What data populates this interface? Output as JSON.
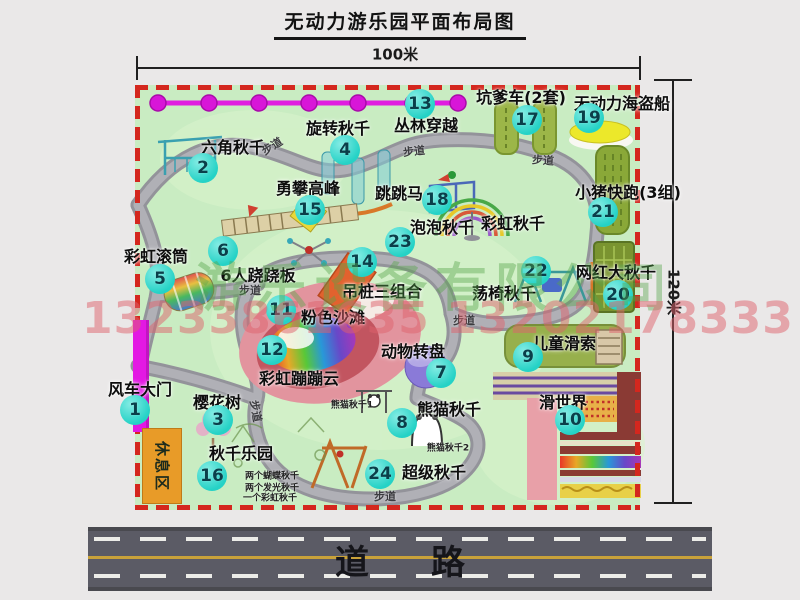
{
  "title": "无动力游乐园平面布局图",
  "dimensions": {
    "width": "100米",
    "height": "120米"
  },
  "road": {
    "char1": "道",
    "char2": "路"
  },
  "watermark": {
    "company": "游乐设备有限公司",
    "phone": "13233861635 13202178333"
  },
  "colors": {
    "border_red": "#d4271e",
    "park_green": "#c9ecc2",
    "badge_teal": "#2fd8cd",
    "gate_magenta": "#e318e3",
    "road_gray": "#5b5b65",
    "rest_area_orange": "#e89b28"
  },
  "park": {
    "rest_area": "休息区",
    "attractions": [
      {
        "n": "1",
        "label": "风车大门",
        "bx": 135,
        "by": 410,
        "lx": 140,
        "ly": 388
      },
      {
        "n": "2",
        "label": "六角秋千",
        "bx": 203,
        "by": 168,
        "lx": 233,
        "ly": 146
      },
      {
        "n": "3",
        "label": "樱花树",
        "bx": 218,
        "by": 420,
        "lx": 217,
        "ly": 401
      },
      {
        "n": "4",
        "label": "旋转秋千",
        "bx": 345,
        "by": 150,
        "lx": 338,
        "ly": 127
      },
      {
        "n": "5",
        "label": "彩虹滚筒",
        "bx": 160,
        "by": 279,
        "lx": 156,
        "ly": 255
      },
      {
        "n": "6",
        "label": "6人跷跷板",
        "bx": 223,
        "by": 251,
        "lx": 258,
        "ly": 274
      },
      {
        "n": "7",
        "label": "动物转盘",
        "bx": 441,
        "by": 373,
        "lx": 413,
        "ly": 350
      },
      {
        "n": "8",
        "label": "熊猫秋千",
        "bx": 402,
        "by": 423,
        "lx": 449,
        "ly": 408
      },
      {
        "n": "9",
        "label": "儿童滑索",
        "bx": 528,
        "by": 357,
        "lx": 564,
        "ly": 342
      },
      {
        "n": "10",
        "label": "滑世界",
        "bx": 570,
        "by": 420,
        "lx": 563,
        "ly": 401
      },
      {
        "n": "11",
        "label": "粉色沙滩",
        "bx": 281,
        "by": 310,
        "lx": 333,
        "ly": 316
      },
      {
        "n": "12",
        "label": "彩虹蹦蹦云",
        "bx": 272,
        "by": 350,
        "lx": 299,
        "ly": 377
      },
      {
        "n": "13",
        "label": "丛林穿越",
        "bx": 420,
        "by": 104,
        "lx": 426,
        "ly": 124
      },
      {
        "n": "14",
        "label": "吊桩三组合",
        "bx": 362,
        "by": 262,
        "lx": 382,
        "ly": 290
      },
      {
        "n": "15",
        "label": "勇攀高峰",
        "bx": 310,
        "by": 210,
        "lx": 308,
        "ly": 187
      },
      {
        "n": "16",
        "label": "秋千乐园",
        "bx": 212,
        "by": 476,
        "lx": 241,
        "ly": 452
      },
      {
        "n": "17",
        "label": "坑爹车(2套)",
        "bx": 527,
        "by": 120,
        "lx": 521,
        "ly": 96
      },
      {
        "n": "18",
        "label": "跳跳马",
        "bx": 437,
        "by": 200,
        "lx": 399,
        "ly": 192
      },
      {
        "n": "19",
        "label": "无动力海盗船",
        "bx": 589,
        "by": 118,
        "lx": 622,
        "ly": 102
      },
      {
        "n": "20",
        "label": "网红大秋千",
        "bx": 618,
        "by": 295,
        "lx": 616,
        "ly": 271
      },
      {
        "n": "21",
        "label": "小猪快跑(3组)",
        "bx": 603,
        "by": 212,
        "lx": 628,
        "ly": 191
      },
      {
        "n": "22",
        "label": "荡椅秋千",
        "bx": 536,
        "by": 271,
        "lx": 504,
        "ly": 292
      },
      {
        "n": "23",
        "label": "泡泡秋千",
        "bx": 400,
        "by": 242,
        "lx": 442,
        "ly": 226
      },
      {
        "n": "24",
        "label": "超级秋千",
        "bx": 380,
        "by": 474,
        "lx": 434,
        "ly": 471
      }
    ],
    "extra_labels": [
      {
        "text": "彩虹秋千",
        "x": 513,
        "y": 222
      }
    ],
    "path_labels": [
      {
        "text": "步道",
        "x": 272,
        "y": 146,
        "r": -32
      },
      {
        "text": "步道",
        "x": 414,
        "y": 151,
        "r": -6
      },
      {
        "text": "步道",
        "x": 543,
        "y": 160,
        "r": 4
      },
      {
        "text": "步道",
        "x": 250,
        "y": 290,
        "r": 0
      },
      {
        "text": "步道",
        "x": 464,
        "y": 320,
        "r": 0
      },
      {
        "text": "步道",
        "x": 256,
        "y": 411,
        "r": 80
      },
      {
        "text": "步道",
        "x": 385,
        "y": 496,
        "r": 0
      }
    ],
    "notes": [
      {
        "text": "熊猫秋千1",
        "x": 352,
        "y": 404
      },
      {
        "text": "熊猫秋千2",
        "x": 448,
        "y": 447
      },
      {
        "text": "两个蝴蝶秋千",
        "x": 272,
        "y": 475
      },
      {
        "text": "两个发光秋千",
        "x": 272,
        "y": 487
      },
      {
        "text": "一个彩虹秋千",
        "x": 270,
        "y": 497
      }
    ]
  }
}
